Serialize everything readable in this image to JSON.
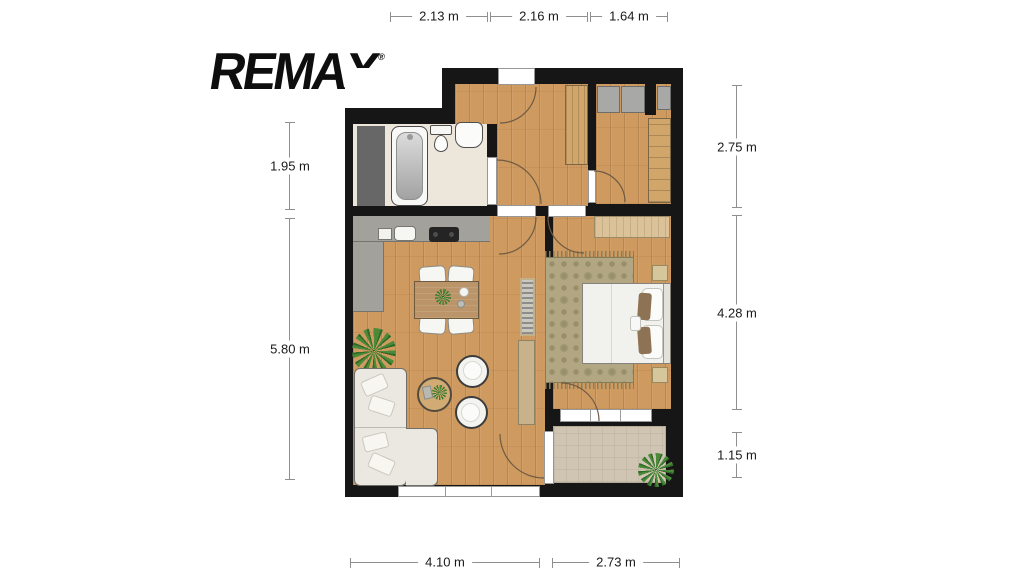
{
  "logo": {
    "brand": "REMAX",
    "registered_mark": "®"
  },
  "dimensions": {
    "top": [
      "2.13 m",
      "2.16 m",
      "1.64 m"
    ],
    "left": [
      "1.95 m",
      "5.80 m"
    ],
    "right": [
      "2.75 m",
      "4.28 m",
      "1.15 m"
    ],
    "bottom": [
      "4.10 m",
      "2.73 m"
    ]
  },
  "floorplan": {
    "type": "apartment-top-view",
    "rooms": [
      "bathroom",
      "hallway",
      "storage-room",
      "living-room-with-kitchen",
      "bedroom",
      "balcony"
    ],
    "fixtures": [
      "shower-area",
      "bathtub",
      "toilet",
      "washbasin",
      "hall-wardrobe",
      "storage-cabinets",
      "tall-wardrobe",
      "kitchen-counter",
      "kitchen-sink",
      "cooktop",
      "dining-table",
      "dining-chairs",
      "houseplant",
      "sofa",
      "coffee-table",
      "poufs",
      "radiator",
      "tv-sideboard",
      "bedroom-sideboard",
      "rug",
      "bed",
      "pillows",
      "nightstands",
      "balcony-mat",
      "balcony-plant",
      "entrance-door",
      "interior-doors",
      "windows"
    ]
  },
  "colors": {
    "walls": "#161616",
    "wood_floor": "#cf9a5f",
    "bathroom_floor": "#ece6db",
    "kitchen_counter": "#a3a19c",
    "sofa": "#eae8e0",
    "rug": "#b2a683",
    "furniture_wood": "#d0a66a",
    "balcony_mat": "#cfc5b2",
    "dimension_line": "#8f8f8f",
    "text": "#1a1a1a",
    "background": "#ffffff"
  }
}
